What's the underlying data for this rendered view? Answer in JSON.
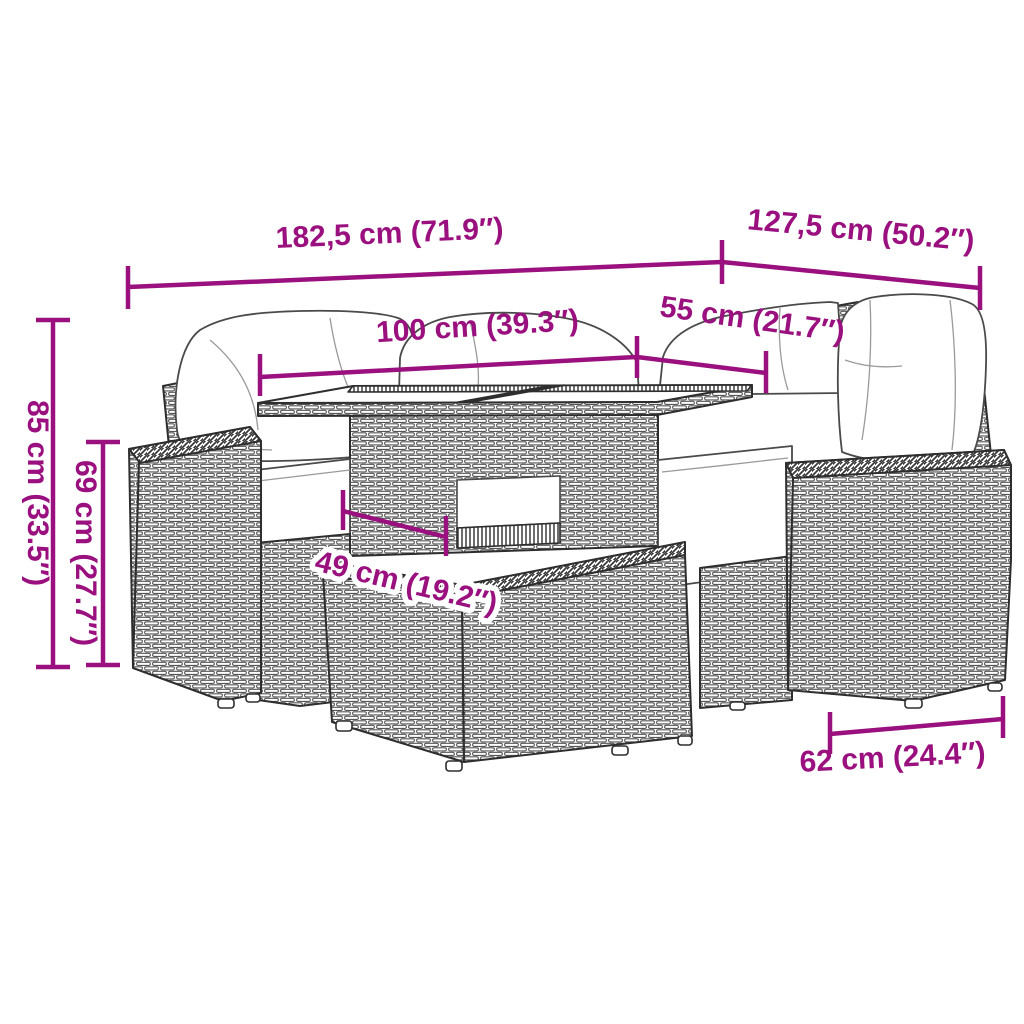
{
  "page": {
    "background": "#ffffff",
    "alt": "Dimension diagram of a poly rattan garden furniture set with two sofa sections, a table and an ottoman"
  },
  "colors": {
    "dimension_accent": "#9A107E",
    "line_art": "#2E2E2E",
    "cushion_fill": "#FFFFFF"
  },
  "dimensions": [
    {
      "id": "overall-width-left",
      "label": "182,5 cm (71.9″)"
    },
    {
      "id": "overall-width-right",
      "label": "127,5 cm (50.2″)"
    },
    {
      "id": "table-length",
      "label": "100 cm (39.3″)"
    },
    {
      "id": "table-depth",
      "label": "55 cm (21.7″)"
    },
    {
      "id": "overall-height",
      "label": "85 cm (33.5″)"
    },
    {
      "id": "armrest-height",
      "label": "69 cm (27.7″)"
    },
    {
      "id": "table-clearance",
      "label": "49 cm (19.2″)"
    },
    {
      "id": "ottoman-width",
      "label": "62 cm (24.4″)"
    }
  ]
}
